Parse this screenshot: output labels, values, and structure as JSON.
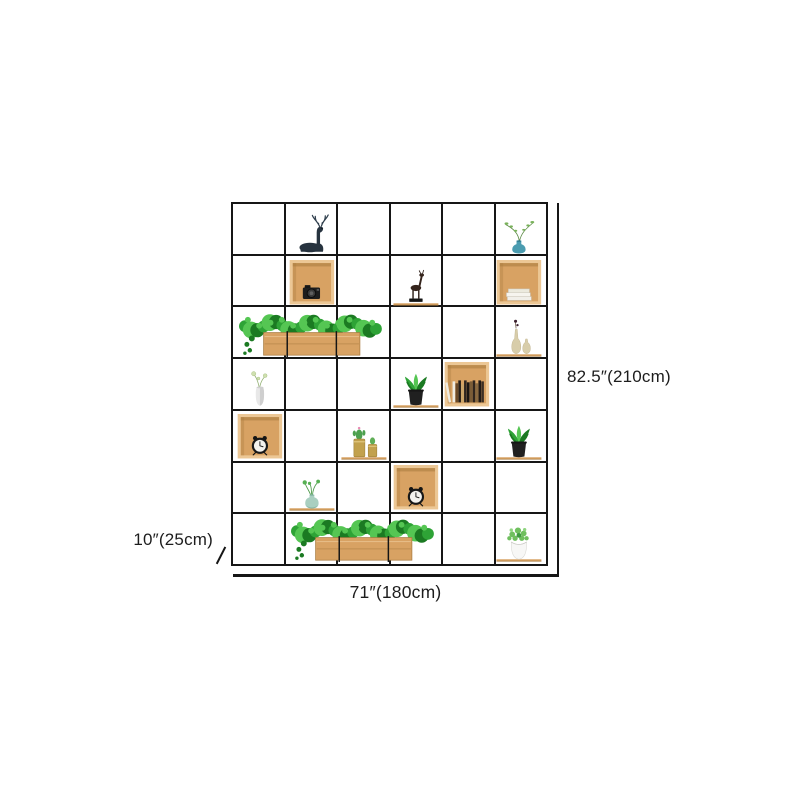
{
  "page": {
    "background": "#ffffff"
  },
  "shelf": {
    "grid": {
      "columns": 6,
      "rows": 7
    },
    "frame_color": "#161616",
    "items": [
      {
        "row": 1,
        "col": 2,
        "span": 1,
        "type": "deer-ornament",
        "plank": false
      },
      {
        "row": 1,
        "col": 6,
        "span": 1,
        "type": "teal-vase-branch",
        "plank": false
      },
      {
        "row": 2,
        "col": 2,
        "span": 1,
        "type": "wood-box-camera",
        "plank": false
      },
      {
        "row": 2,
        "col": 4,
        "span": 1,
        "type": "deer-figurine",
        "plank": true
      },
      {
        "row": 2,
        "col": 6,
        "span": 1,
        "type": "wood-box-books",
        "plank": false
      },
      {
        "row": 3,
        "col": 1,
        "span": 3,
        "type": "planter-box",
        "plank": false
      },
      {
        "row": 3,
        "col": 6,
        "span": 1,
        "type": "cream-vases",
        "plank": true
      },
      {
        "row": 4,
        "col": 1,
        "span": 1,
        "type": "white-vase-sprigs",
        "plank": false
      },
      {
        "row": 4,
        "col": 4,
        "span": 1,
        "type": "potted-plant-black",
        "plank": true
      },
      {
        "row": 4,
        "col": 5,
        "span": 1,
        "type": "wood-box-library",
        "plank": false
      },
      {
        "row": 5,
        "col": 1,
        "span": 1,
        "type": "wood-box-clock",
        "plank": false
      },
      {
        "row": 5,
        "col": 3,
        "span": 1,
        "type": "gold-canisters-cactus",
        "plank": true
      },
      {
        "row": 5,
        "col": 6,
        "span": 1,
        "type": "potted-plant-black",
        "plank": true
      },
      {
        "row": 6,
        "col": 2,
        "span": 1,
        "type": "celadon-vase-sprouts",
        "plank": true
      },
      {
        "row": 6,
        "col": 4,
        "span": 1,
        "type": "wood-box-clock",
        "plank": false
      },
      {
        "row": 7,
        "col": 2,
        "span": 3,
        "type": "planter-box",
        "plank": false
      },
      {
        "row": 7,
        "col": 6,
        "span": 1,
        "type": "potted-plant-white",
        "plank": true
      }
    ]
  },
  "dimensions": {
    "height_label": "82.5″(210cm)",
    "width_label": "71″(180cm)",
    "depth_label": "10″(25cm)"
  },
  "colors": {
    "line": "#161616",
    "text": "#1d1d1d",
    "wood": "#d8a263",
    "wood_dark": "#a87a3e",
    "wood_light": "#ecc795",
    "leaf": "#2ea336",
    "leaf_light": "#55c653",
    "leaf_dark": "#1b7a22",
    "black": "#1f1f1f",
    "teal": "#4b9cb0",
    "celadon": "#a9cfc0",
    "cream": "#d8cdaa",
    "gold": "#c2a14d",
    "white_pot": "#f7f7f6"
  }
}
